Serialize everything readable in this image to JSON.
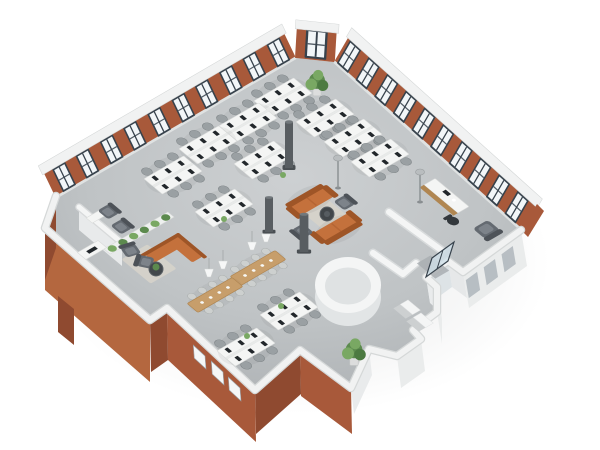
{
  "scene": {
    "description": "3D isometric floor plan rendering of an open-plan office loft with exposed brick walls and white furniture",
    "view": "isometric-top-down",
    "background": "#ffffff"
  },
  "colors": {
    "floor_light": "#cdd0d2",
    "floor": "#bfc3c5",
    "floor_dark": "#a9adb0",
    "brick": "#a8593a",
    "brick_light": "#b4673f",
    "brick_dark": "#8f4a30",
    "wall_cap": "#f1f2f2",
    "wall_cap_edge": "#d5d8d8",
    "wall_face_light": "#eaecec",
    "window_frame": "#37424c",
    "window_glass": "#f2f6f8",
    "desk": "#f4f5f4",
    "monitor": "#22272b",
    "chair": "#9aa0a3",
    "chair_light": "#cdd0cf",
    "task_chair": "#33383c",
    "sofa": "#c4713c",
    "sofa_dark": "#9e5527",
    "armchair": "#646a71",
    "armchair_dark": "#4d5258",
    "wood": "#c79e6b",
    "wood_dark": "#b08651",
    "rug": "#d6d3ca",
    "plant": "#5c8a4e",
    "plant_light": "#79a863",
    "column": "#585d61",
    "core_wall": "#f4f5f5",
    "core_side": "#e2e5e6",
    "core_floor": "#dfe2e3",
    "glass_door": "#cfe0e8",
    "lamp": "#f6f7f7",
    "mat": "#a9aeb1"
  },
  "objects": {
    "workstation_clusters": 11,
    "chairs_per_cluster": 6,
    "monitors_per_cluster": 6,
    "long_dining_tables": 2,
    "pendant_lamps": 4,
    "lounge_sofas": 2,
    "corner_sofa": 1,
    "lounge_armchairs": 2,
    "wing_armchairs": 2,
    "office_armchairs": 2,
    "corner_armchair": 1,
    "coffee_tables": 2,
    "reception_desk": 1,
    "reception_chair": 1,
    "plant_wall": 1,
    "large_plants": 2,
    "desk_plants": 4,
    "columns": 3,
    "floor_lamps": 2,
    "round_core_room": 1,
    "glass_entry_door": 1,
    "entry_mat": 1,
    "step_blocks": 2,
    "windows_northwest_wall": 10,
    "windows_northeast_wall": 10,
    "chamfer_corner_window": 1,
    "windows_southwest_wall": 3
  }
}
